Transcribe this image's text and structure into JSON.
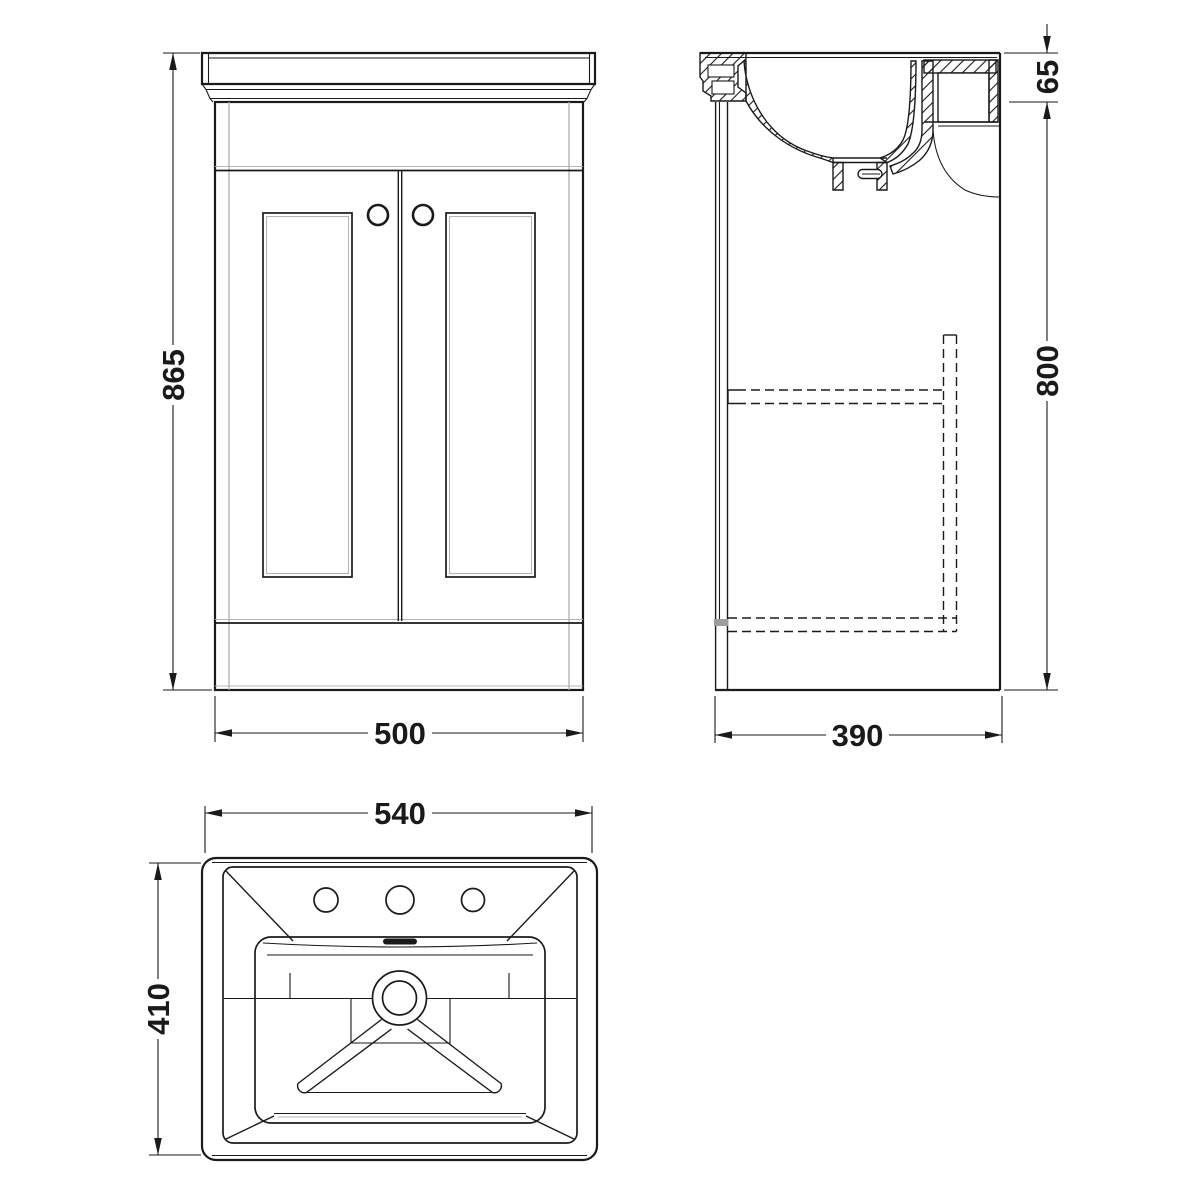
{
  "colors": {
    "line": "#1a1a1a",
    "light": "#b5b5b5",
    "grey_fill": "#9c9c9c",
    "background": "#ffffff"
  },
  "dimensions": {
    "front_height": "865",
    "front_width": "500",
    "basin_rim_height": "65",
    "side_height": "800",
    "side_depth": "390",
    "plan_width": "540",
    "plan_depth": "410"
  }
}
